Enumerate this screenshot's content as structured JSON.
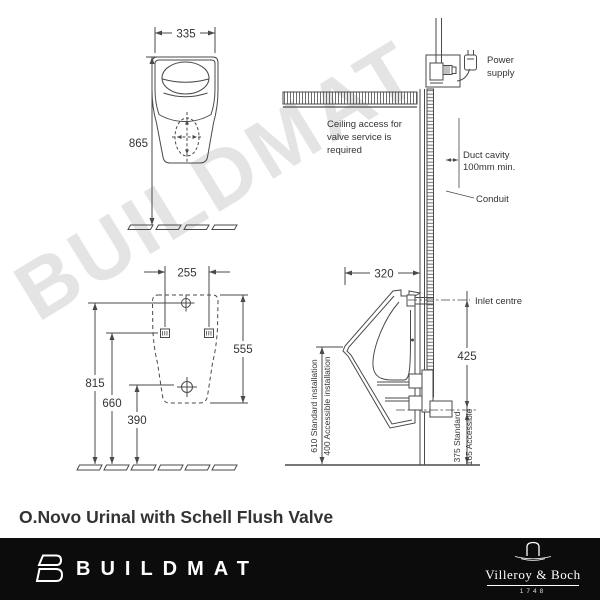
{
  "watermark_text": "BUILDMAT",
  "title": "O.Novo Urinal with Schell Flush Valve",
  "front_view": {
    "dim_width": "335",
    "dim_height": "865"
  },
  "mounting_view": {
    "dim_width": "255",
    "dim_right": "555",
    "dim_h1": "815",
    "dim_h2": "660",
    "dim_h3": "390"
  },
  "side_view": {
    "dim_depth": "320",
    "power_line1": "Power",
    "power_line2": "supply",
    "ceiling_line1": "Ceiling access for",
    "ceiling_line2": "valve service is",
    "ceiling_line3": "required",
    "duct_line1": "Duct cavity",
    "duct_line2": "100mm min.",
    "conduit": "Conduit",
    "inlet": "Inlet centre",
    "dim_inlet_to_outlet": "425",
    "standard_install": "610 Standard installation",
    "accessible_install": "400 Accessible installation",
    "outlet_standard": "375 Standard",
    "outlet_accessible": "165 Accessible"
  },
  "footer": {
    "brand": "BUILDMAT",
    "manufacturer": "Villeroy & Boch",
    "established": "1748"
  },
  "colors": {
    "line": "#4a4a4a",
    "text": "#333333",
    "watermark": "#e4e4e4",
    "footer_bg": "#0c0c0c",
    "footer_text": "#ffffff"
  }
}
